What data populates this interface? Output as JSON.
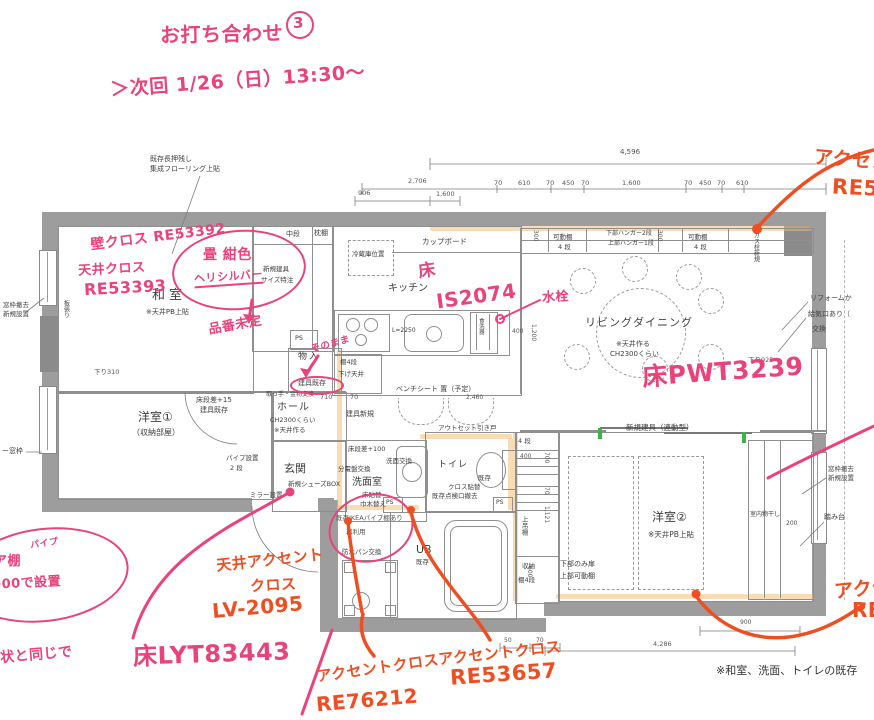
{
  "notes": {
    "title": "お打ち合わせ",
    "title_no": "3",
    "next": "＞次回 1/26（日）13:30〜"
  },
  "hw_pink": {
    "wall_cloth": "壁クロス RE53392",
    "ceil_cloth1": "天井クロス",
    "ceil_cloth2": "RE53393",
    "tatami1": "畳 紺色",
    "tatami2": "ヘリシルバー",
    "tatami3": "品番未定",
    "floor_prefix": "床",
    "kitchen_floor": "IS2074",
    "faucet": "水栓",
    "ld_floor": "床PWT3239",
    "as_is": "そのまま",
    "entrance_floor": "床LYT83443",
    "pipe1": "パイプ",
    "pipe2": "ア棚",
    "pipe3": "900で設置",
    "same_as": "状と同じで"
  },
  "hw_orange": {
    "tr1": "アクセント",
    "tr2": "RE53",
    "ceil1": "天井アクセント",
    "ceil2": "クロス",
    "ceil3": "LV-2095",
    "a1_label": "アクセントクロス",
    "a1_code": "RE76212",
    "a2_label": "アクセントクロス",
    "a2_code": "RE53657",
    "br1": "アクセント",
    "br2": "RE"
  },
  "rooms": {
    "washitsu": "和室",
    "washitsu_note": "※天井PB上貼",
    "yoshitsu1": "洋室①",
    "yoshitsu1_note": "（収納部屋）",
    "hall": "ホール",
    "hall_note1": "CH2300くらい",
    "hall_note2": "※天井作る",
    "genkan": "玄関",
    "senmen": "洗面室",
    "senmen_note1": "床貼替",
    "senmen_note2": "巾木替え",
    "toilet": "トイレ",
    "toilet_note1": "既存",
    "toilet_note2": "クロス貼替",
    "toilet_note3": "既存点検口撤去",
    "ub": "UB",
    "ub_note": "既存",
    "ld": "リビングダイニング",
    "ld_note1": "※天井作る",
    "ld_note2": "CH2300くらい",
    "kitchen": "キッチン",
    "yoshitsu2": "洋室②",
    "yoshitsu2_note": "※天井PB上貼",
    "monoire": "物入"
  },
  "labels": {
    "chudan": "中段",
    "makuradana": "枕棚",
    "shinki_tategu": "新規建具",
    "size_tokuchu": "サイズ特注",
    "ps": "PS",
    "reizouko": "冷蔵庫位置",
    "cupboard": "カップボード",
    "l2250": "L=2250",
    "shokusenki": "食洗器",
    "tana4dan": "棚4段",
    "sagetenjo": "下げ天井",
    "kado": "可動棚",
    "yondan": "4 段",
    "hanger1": "下部ハンガー2段",
    "hanger2": "上部ハンガー1段",
    "gasusen": "ガス栓新規",
    "bench": "ベンチシート 置（予定）",
    "tategu_shinki": "建具新規",
    "outset": "アウトセット引き戸",
    "dansa15": "床段差+15",
    "tategu_kison": "建具既存",
    "totte": "取っ手・金物交換",
    "pipe_setchi": "パイプ設置",
    "pipe_2dan": "2 段",
    "shoes": "新規シューズBOX",
    "mirror": "ミラー設置",
    "dansa100": "床段差+100",
    "bunden": "分電盤交換",
    "senmen_koukan": "洗面交換",
    "bousui": "防水パン交換",
    "ikea1": "既存IKEAパイプ棚あり",
    "ikea2": "再利用",
    "shuno": "収納",
    "tana4dan2": "棚4段",
    "uwazuri": "上吊棚",
    "shita_tobira": "下部のみ扉",
    "joubu_kado": "上部可動棚",
    "rendou": "新規建具（連動型）",
    "monohoshi": "室内物干し",
    "madowaku1": "窓枠撤去",
    "madowaku2": "新規設置",
    "fumidai": "踏み台",
    "cover_waku": "ー窓枠",
    "itabari": "板張り",
    "nageshi1": "既存長押残し",
    "nageshi2": "集成フローリング上貼",
    "reform": "リフォームか",
    "kyuki": "給気口あり（",
    "koukan": "交換"
  },
  "dims": {
    "total": "4,596",
    "top": [
      "2,706",
      "70",
      "610",
      "70",
      "450",
      "70",
      "1,600",
      "70",
      "450",
      "70",
      "610"
    ],
    "row2": [
      "906",
      "1,600"
    ],
    "sagari310": "下り310",
    "sagari925": "下り925",
    "hall710": "710",
    "hall70": "70",
    "bench2460": "2,460",
    "k400": "400",
    "k1200": "1,200",
    "v300": "300",
    "c400": "400",
    "right_col": [
      "700",
      "70",
      "1,121",
      "600"
    ],
    "r200": "200",
    "b50": "50",
    "b70": "70",
    "b900": "900",
    "b4286": "4,286"
  },
  "footnote": "※和室、洗面、トイレの既存"
}
